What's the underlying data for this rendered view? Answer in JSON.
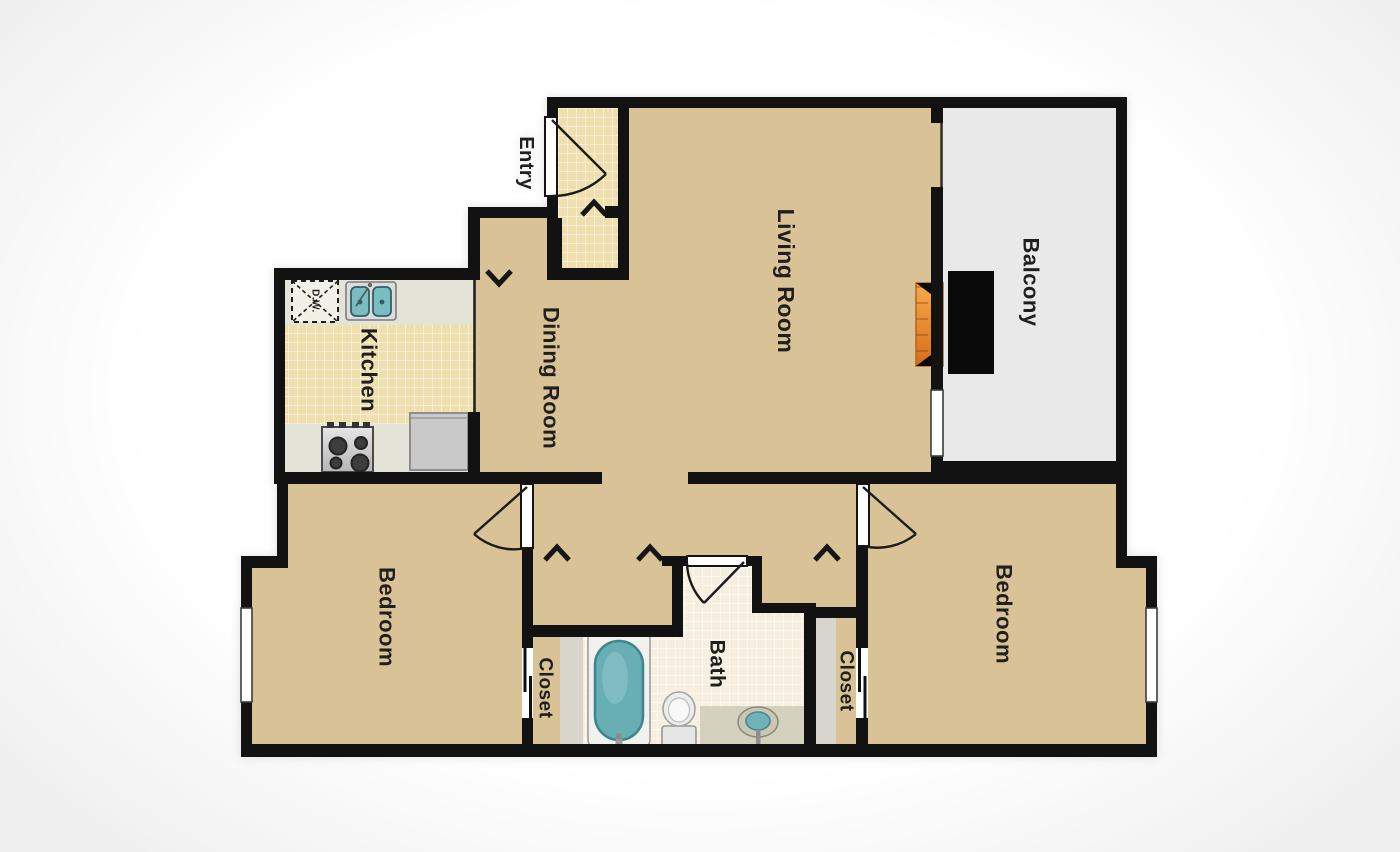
{
  "labels": {
    "entry": "Entry",
    "living_room": "Living Room",
    "balcony": "Balcony",
    "dining_room": "Dining Room",
    "kitchen": "Kitchen",
    "bedroom_left": "Bedroom",
    "bedroom_right": "Bedroom",
    "bath": "Bath",
    "closet_left": "Closet",
    "closet_right": "Closet",
    "dishwasher": "D.W."
  },
  "colors": {
    "wall": "#121212",
    "room_tan": "#d9c296",
    "tile_kitchen": "#f0dfae",
    "tile_bath": "#f6efdf",
    "balcony": "#e9e9e9",
    "counter": "#e4e3d8",
    "closet_shelf": "#d7d5cc",
    "appliance": "#c9c9c9",
    "tub": "#67aeb5",
    "flame_light": "#f5a94b",
    "flame_dark": "#d96e1a",
    "background": "#ffffff"
  },
  "fixtures": [
    "entry-door",
    "bedroom-door",
    "bathroom-door",
    "sliding-patio-door",
    "window",
    "fireplace",
    "kitchen-sink",
    "dishwasher",
    "range-stove",
    "refrigerator",
    "bathtub",
    "toilet",
    "vanity-sink",
    "closet-sliding-door"
  ]
}
